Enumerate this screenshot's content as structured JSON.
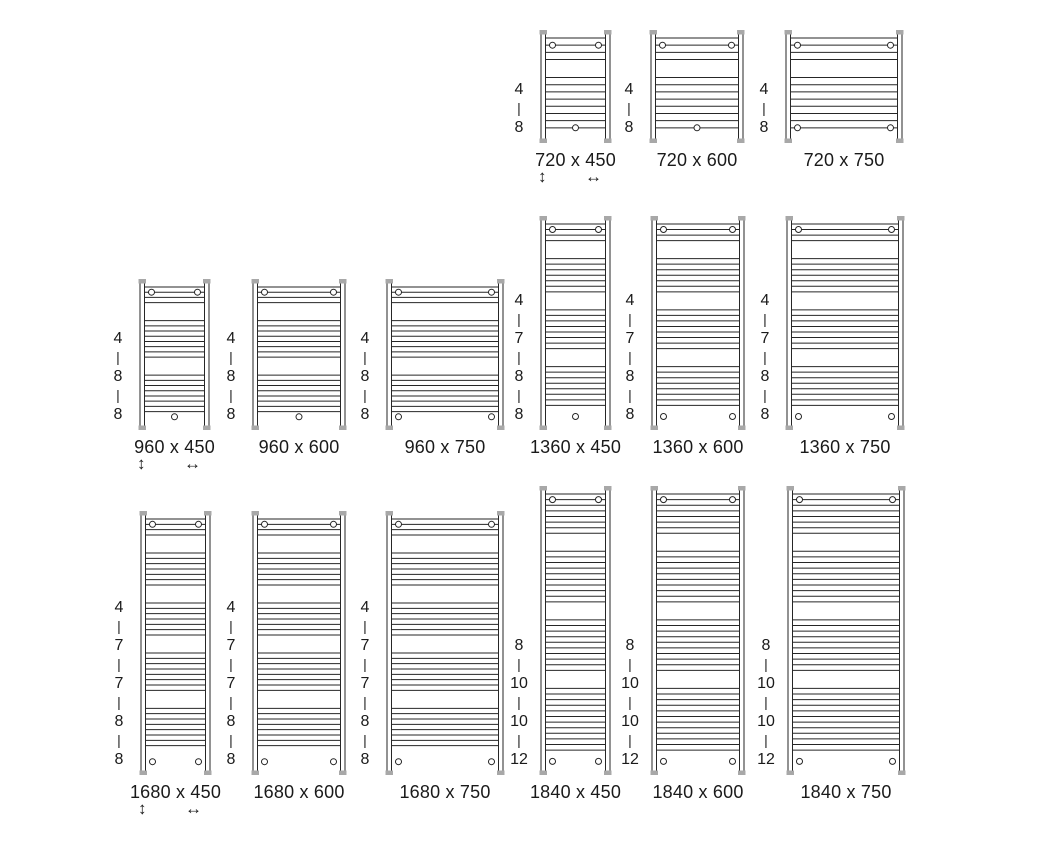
{
  "figure": {
    "type": "radiator-size-diagram",
    "colors": {
      "line": "#262626",
      "cap": "#a8a8a8",
      "text": "#1a1a1a",
      "background": "#ffffff"
    },
    "scale_px_per_mm": 0.157,
    "group_separator": "|",
    "icons": {
      "height_arrow": "↕",
      "width_arrow": "↔"
    },
    "rows": [
      {
        "bottom_y": 143,
        "models": [
          {
            "label": "720 x 450",
            "height_mm": 720,
            "width_mm": 450,
            "x": 540,
            "bar_groups": [
              4,
              8
            ],
            "top_brackets": 2,
            "bottom_brackets": 1,
            "show_arrows": true
          },
          {
            "label": "720 x 600",
            "height_mm": 720,
            "width_mm": 600,
            "x": 650,
            "bar_groups": [
              4,
              8
            ],
            "top_brackets": 2,
            "bottom_brackets": 1,
            "show_arrows": false
          },
          {
            "label": "720 x 750",
            "height_mm": 720,
            "width_mm": 750,
            "x": 785,
            "bar_groups": [
              4,
              8
            ],
            "top_brackets": 2,
            "bottom_brackets": 2,
            "show_arrows": false
          }
        ]
      },
      {
        "bottom_y": 430,
        "models": [
          {
            "label": "960 x 450",
            "height_mm": 960,
            "width_mm": 450,
            "x": 139,
            "bar_groups": [
              4,
              8,
              8
            ],
            "top_brackets": 2,
            "bottom_brackets": 1,
            "show_arrows": true
          },
          {
            "label": "960 x 600",
            "height_mm": 960,
            "width_mm": 600,
            "x": 252,
            "bar_groups": [
              4,
              8,
              8
            ],
            "top_brackets": 2,
            "bottom_brackets": 1,
            "show_arrows": false
          },
          {
            "label": "960 x 750",
            "height_mm": 960,
            "width_mm": 750,
            "x": 386,
            "bar_groups": [
              4,
              8,
              8
            ],
            "top_brackets": 2,
            "bottom_brackets": 2,
            "show_arrows": false
          },
          {
            "label": "1360 x 450",
            "height_mm": 1360,
            "width_mm": 450,
            "x": 540,
            "bar_groups": [
              4,
              7,
              8,
              8
            ],
            "top_brackets": 2,
            "bottom_brackets": 1,
            "show_arrows": false
          },
          {
            "label": "1360 x 600",
            "height_mm": 1360,
            "width_mm": 600,
            "x": 651,
            "bar_groups": [
              4,
              7,
              8,
              8
            ],
            "top_brackets": 2,
            "bottom_brackets": 2,
            "show_arrows": false
          },
          {
            "label": "1360 x 750",
            "height_mm": 1360,
            "width_mm": 750,
            "x": 786,
            "bar_groups": [
              4,
              7,
              8,
              8
            ],
            "top_brackets": 2,
            "bottom_brackets": 2,
            "show_arrows": false
          }
        ]
      },
      {
        "bottom_y": 775,
        "models": [
          {
            "label": "1680 x 450",
            "height_mm": 1680,
            "width_mm": 450,
            "x": 140,
            "bar_groups": [
              4,
              7,
              7,
              8,
              8
            ],
            "top_brackets": 2,
            "bottom_brackets": 2,
            "show_arrows": true
          },
          {
            "label": "1680 x 600",
            "height_mm": 1680,
            "width_mm": 600,
            "x": 252,
            "bar_groups": [
              4,
              7,
              7,
              8,
              8
            ],
            "top_brackets": 2,
            "bottom_brackets": 2,
            "show_arrows": false
          },
          {
            "label": "1680 x 750",
            "height_mm": 1680,
            "width_mm": 750,
            "x": 386,
            "bar_groups": [
              4,
              7,
              7,
              8,
              8
            ],
            "top_brackets": 2,
            "bottom_brackets": 2,
            "show_arrows": false
          },
          {
            "label": "1840 x 450",
            "height_mm": 1840,
            "width_mm": 450,
            "x": 540,
            "bar_groups": [
              8,
              10,
              10,
              12
            ],
            "top_brackets": 2,
            "bottom_brackets": 2,
            "show_arrows": false
          },
          {
            "label": "1840 x 600",
            "height_mm": 1840,
            "width_mm": 600,
            "x": 651,
            "bar_groups": [
              8,
              10,
              10,
              12
            ],
            "top_brackets": 2,
            "bottom_brackets": 2,
            "show_arrows": false
          },
          {
            "label": "1840 x 750",
            "height_mm": 1840,
            "width_mm": 750,
            "x": 787,
            "bar_groups": [
              8,
              10,
              10,
              12
            ],
            "top_brackets": 2,
            "bottom_brackets": 2,
            "show_arrows": false
          }
        ]
      }
    ]
  }
}
